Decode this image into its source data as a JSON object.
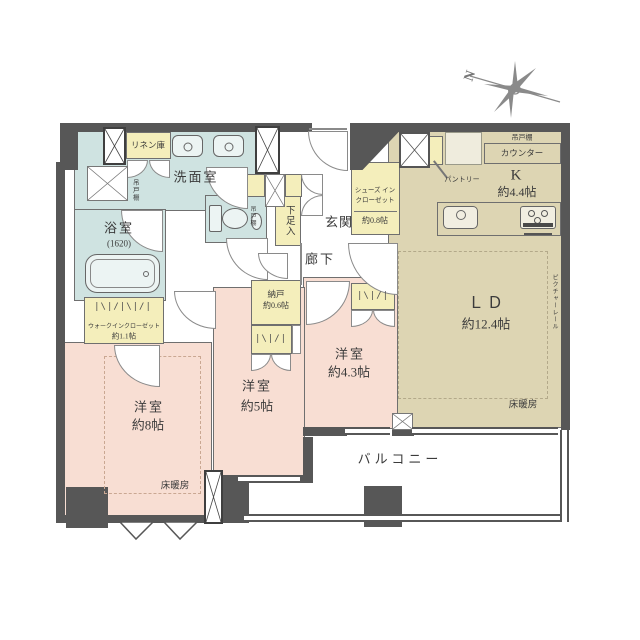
{
  "type": "apartment-floor-plan",
  "compass": {
    "north": "N"
  },
  "rooms": {
    "washroom": {
      "name": "洗面室",
      "cupboard": "吊戸棚"
    },
    "linen": {
      "name": "リネン庫"
    },
    "bathroom": {
      "name": "浴室",
      "size": "(1620)"
    },
    "toilet": {
      "cupboard": "吊戸棚"
    },
    "shoe_cabinet": {
      "name": "下足入"
    },
    "entrance": {
      "name": "玄関"
    },
    "shoes_in_closet": {
      "line1": "シューズ イン",
      "line2": "クローゼット",
      "size": "約0.8帖"
    },
    "kitchen": {
      "name": "K",
      "size": "約4.4帖",
      "counter": "カウンター",
      "cupboard": "吊戸棚",
      "pantry": "パントリー"
    },
    "corridor": {
      "name": "廊下"
    },
    "storage": {
      "name": "納戸",
      "size": "約0.6帖"
    },
    "living_dining": {
      "name": "ＬＤ",
      "size": "約12.4帖",
      "floor_heating": "床暖房",
      "picture_rail": "ピクチャーレール"
    },
    "walk_in_closet": {
      "name": "ウォークインクローゼット",
      "size": "約1.1帖"
    },
    "bedroom_8": {
      "name": "洋室",
      "size": "約8帖",
      "floor_heating": "床暖房"
    },
    "bedroom_5": {
      "name": "洋室",
      "size": "約5帖"
    },
    "bedroom_4_3": {
      "name": "洋室",
      "size": "約4.3帖"
    },
    "balcony": {
      "name": "バルコニー"
    }
  },
  "symbols": {
    "hanger_rail": "|\\|/|\\|/|",
    "hanger_rail_short": "|\\|/|"
  },
  "colors": {
    "wall": "#575757",
    "wet_area": "#cfe3e1",
    "bedroom": "#f8ded3",
    "ldk": "#ddd5b3",
    "closet": "#f4eebb",
    "line": "#6f6f6f"
  }
}
